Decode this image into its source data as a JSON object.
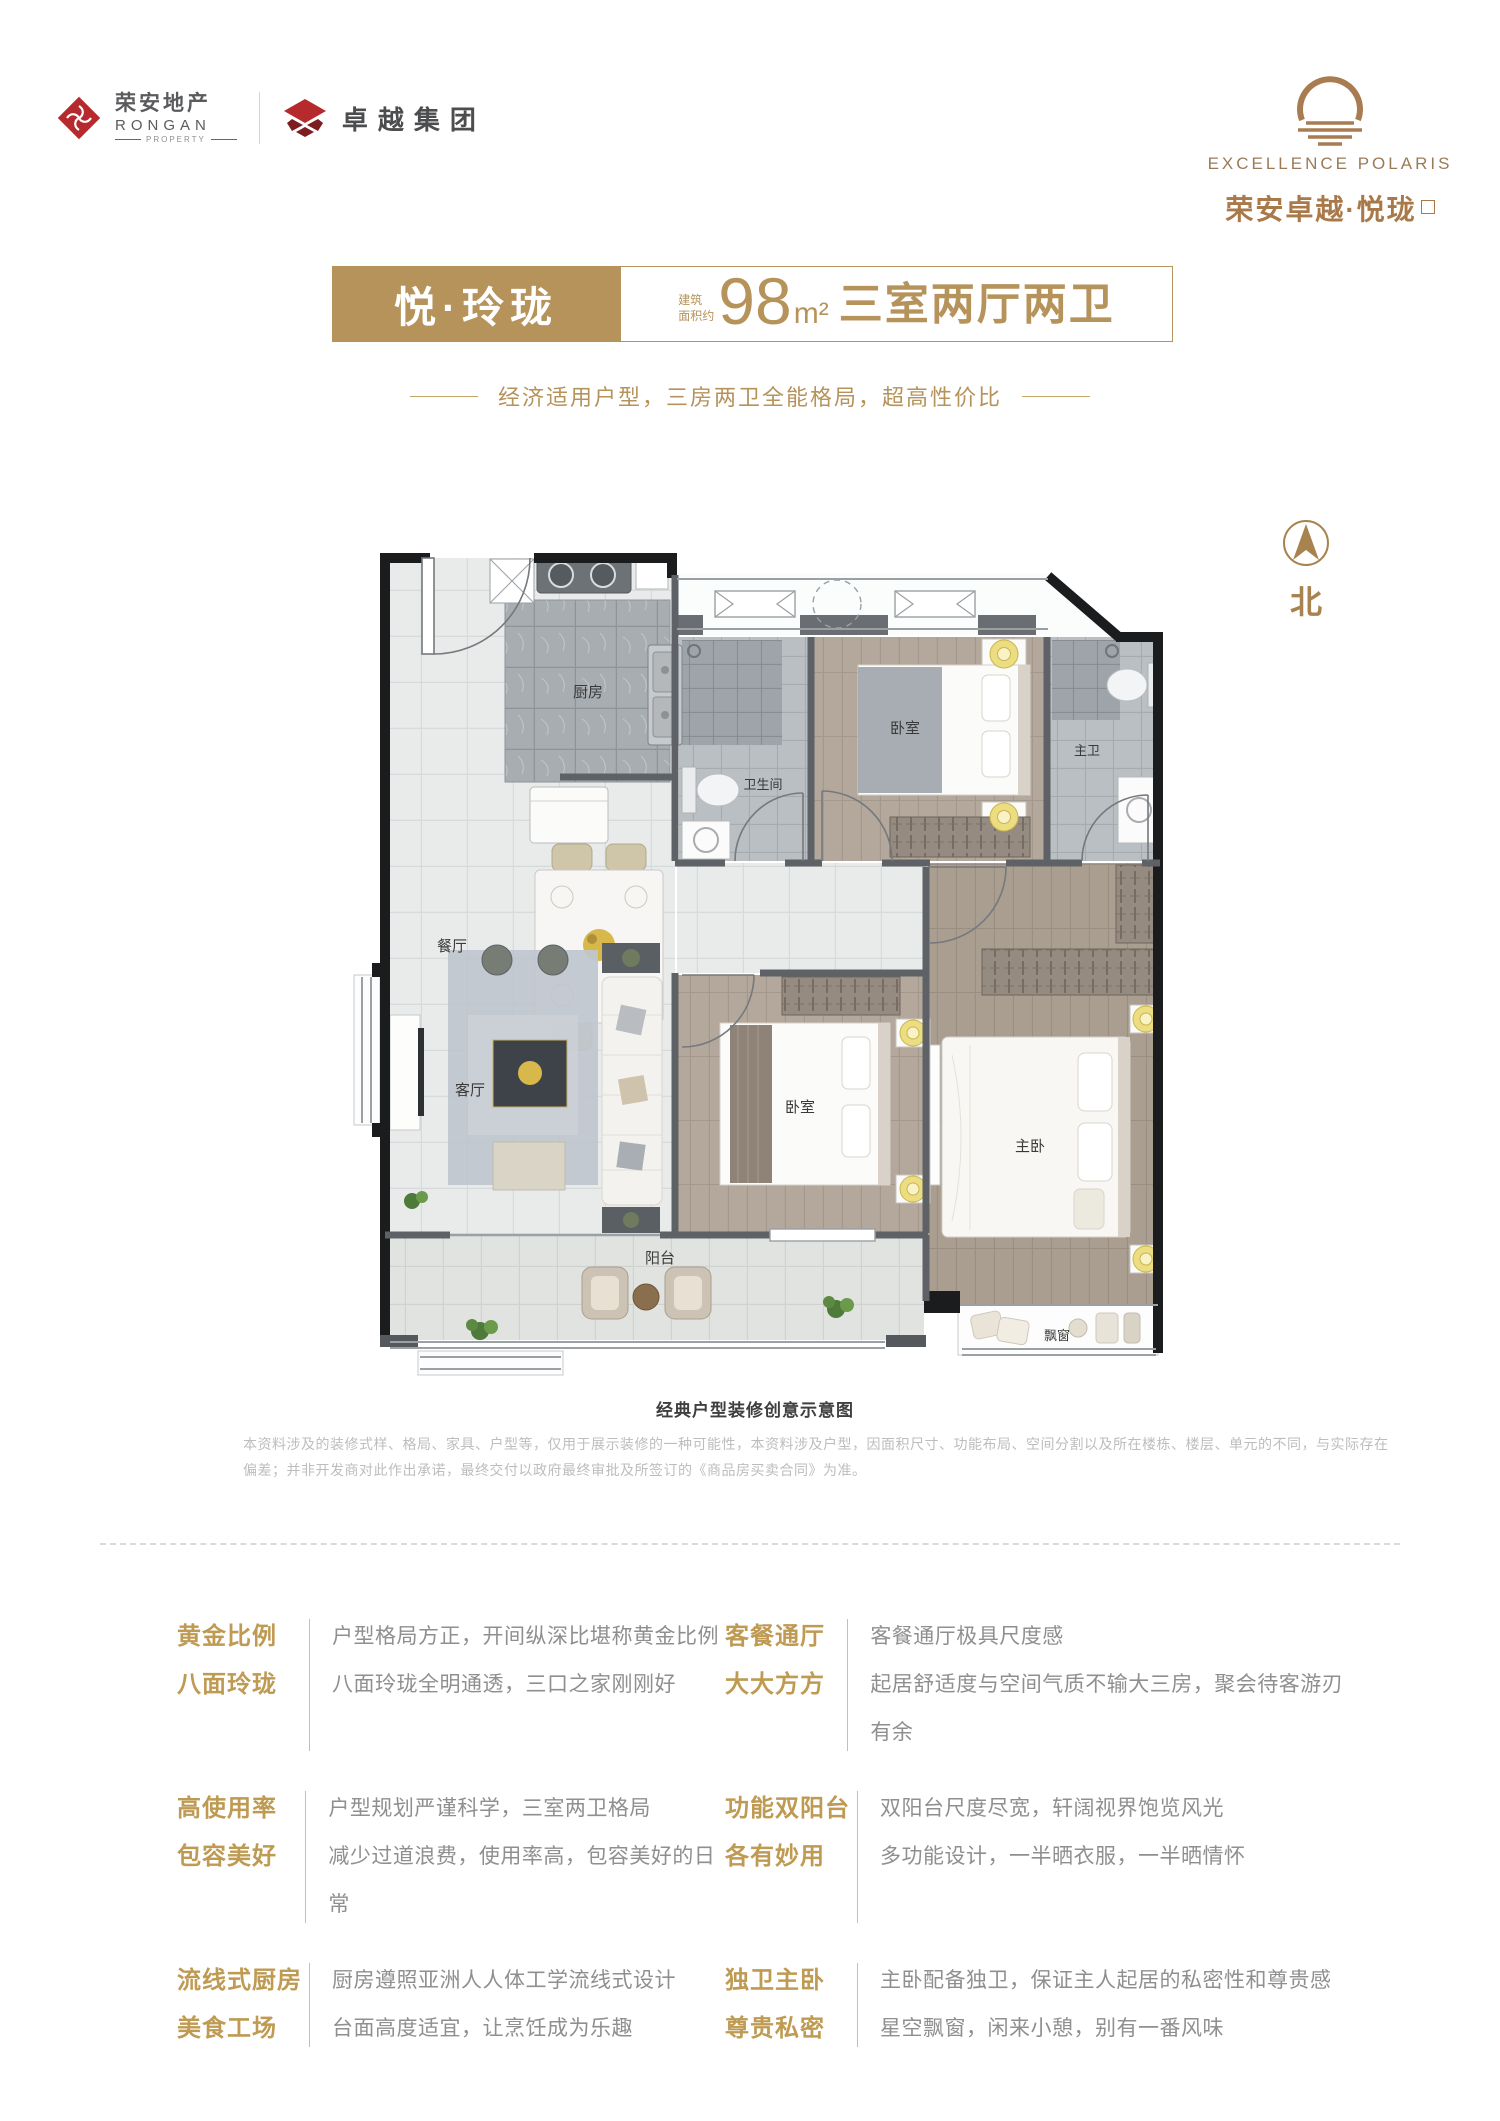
{
  "brand": {
    "rongan_cn": "荣安地产",
    "rongan_en": "RONGAN",
    "rongan_sub": "PROPERTY",
    "zhuoyue": "卓越集团",
    "project_en": "EXCELLENCE POLARIS",
    "project_cn": "荣安卓越·悦珑"
  },
  "title": {
    "name": "悦·玲珑",
    "area_prefix_1": "建筑",
    "area_prefix_2": "面积约",
    "area_value": "98",
    "area_unit": "m²",
    "layout": "三室两厅两卫"
  },
  "subtitle": "经济适用户型，三房两卫全能格局，超高性价比",
  "plan": {
    "north_label": "北",
    "caption": "经典户型装修创意示意图",
    "disclaimer": "本资料涉及的装修式样、格局、家具、户型等，仅用于展示装修的一种可能性，本资料涉及户型，因面积尺寸、功能布局、空间分割以及所在楼栋、楼层、单元的不同，与实际存在偏差；并非开发商对此作出承诺，最终交付以政府最终审批及所签订的《商品房买卖合同》为准。",
    "rooms": {
      "kitchen": "厨房",
      "dining": "餐厅",
      "living": "客厅",
      "balcony": "阳台",
      "bathroom": "卫生间",
      "bedroom_north": "卧室",
      "master_bath": "主卫",
      "bedroom_second": "卧室",
      "master_bedroom": "主卧",
      "bay_window": "飘窗"
    }
  },
  "features": [
    {
      "title_line1": "黄金比例",
      "title_line2": "八面玲珑",
      "desc_line1": "户型格局方正，开间纵深比堪称黄金比例",
      "desc_line2": "八面玲珑全明通透，三口之家刚刚好"
    },
    {
      "title_line1": "客餐通厅",
      "title_line2": "大大方方",
      "desc_line1": "客餐通厅极具尺度感",
      "desc_line2": "起居舒适度与空间气质不输大三房，聚会待客游刃有余"
    },
    {
      "title_line1": "高使用率",
      "title_line2": "包容美好",
      "desc_line1": "户型规划严谨科学，三室两卫格局",
      "desc_line2": "减少过道浪费，使用率高，包容美好的日常"
    },
    {
      "title_line1": "功能双阳台",
      "title_line2": "各有妙用",
      "desc_line1": "双阳台尺度尽宽，轩阔视界饱览风光",
      "desc_line2": "多功能设计，一半晒衣服，一半晒情怀"
    },
    {
      "title_line1": "流线式厨房",
      "title_line2": "美食工场",
      "desc_line1": "厨房遵照亚洲人人体工学流线式设计",
      "desc_line2": "台面高度适宜，让烹饪成为乐趣"
    },
    {
      "title_line1": "独卫主卧",
      "title_line2": "尊贵私密",
      "desc_line1": "主卧配备独卫，保证主人起居的私密性和尊贵感",
      "desc_line2": "星空飘窗，闲来小憩，别有一番风味"
    }
  ],
  "colors": {
    "gold": "#b5935a",
    "bronze": "#a87c50",
    "brand_red": "#b6292d",
    "feature_title": "#bf9a52",
    "text_gray": "#8f8f8f"
  }
}
